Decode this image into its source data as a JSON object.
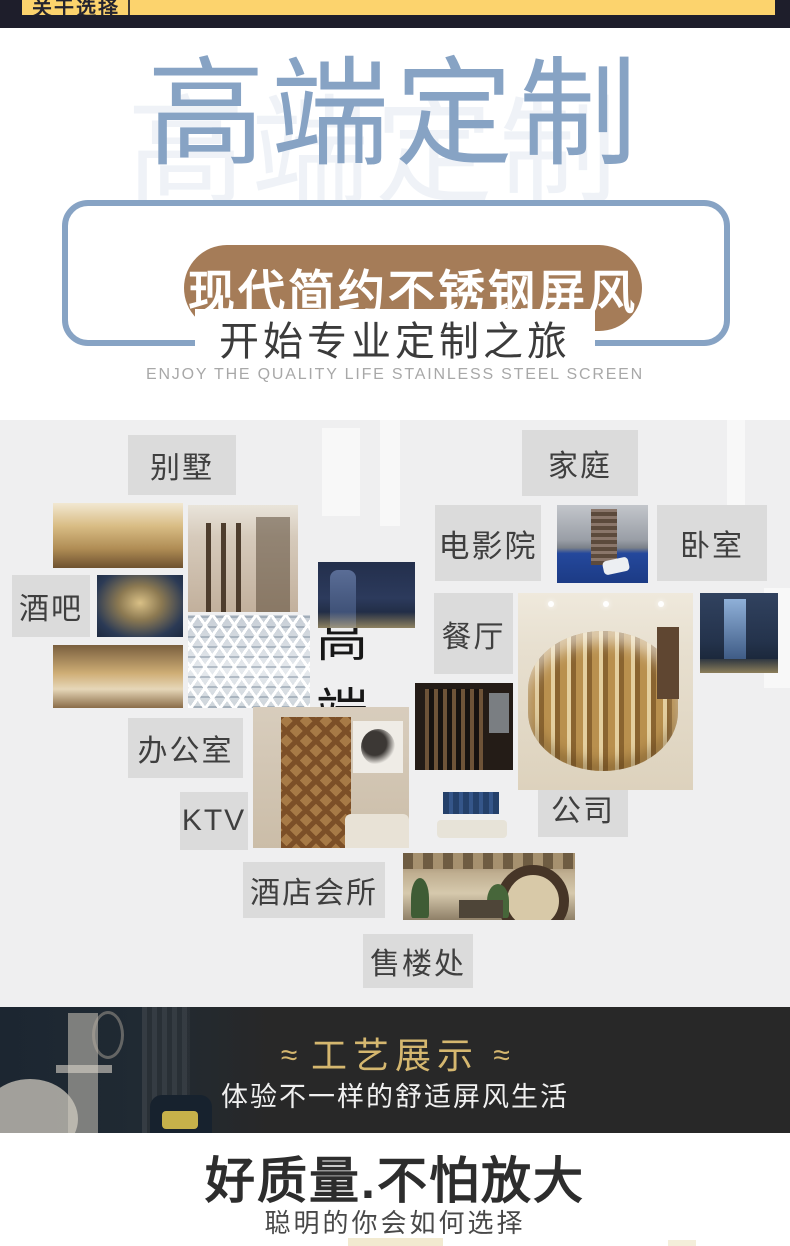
{
  "topbar": {
    "tab_label": "关于选择"
  },
  "hero": {
    "title": "高端定制",
    "pill_label": "现代简约不锈钢屏风",
    "subtitle_cn": "开始专业定制之旅",
    "subtitle_en": "ENJOY THE QUALITY LIFE STAINLESS STEEL SCREEN"
  },
  "collage": {
    "center_word": "高端",
    "labels": {
      "bieshu": "别墅",
      "jiating": "家庭",
      "dianyingyuan": "电影院",
      "woshi": "卧室",
      "jiuba": "酒吧",
      "canting": "餐厅",
      "bangongshi": "办公室",
      "ktv": "KTV",
      "jiudianhuisuo": "酒店会所",
      "gongsi": "公司",
      "shoulouchu": "售楼处"
    }
  },
  "craft_banner": {
    "flourish_left": "≈",
    "title": "工艺展示",
    "flourish_right": "≈",
    "subtitle": "体验不一样的舒适屏风生活"
  },
  "quality": {
    "title": "好质量.不怕放大",
    "subtitle": "聪明的你会如何选择"
  },
  "colors": {
    "navy": "#1e1e2b",
    "yellow": "#fcd36d",
    "accent_blue": "#87a3c4",
    "brown": "#a57c58",
    "collage_bg": "#efeff0",
    "label_bg": "#dbdbdb",
    "gold": "#d5b76f",
    "banner_bg": "#282828"
  }
}
